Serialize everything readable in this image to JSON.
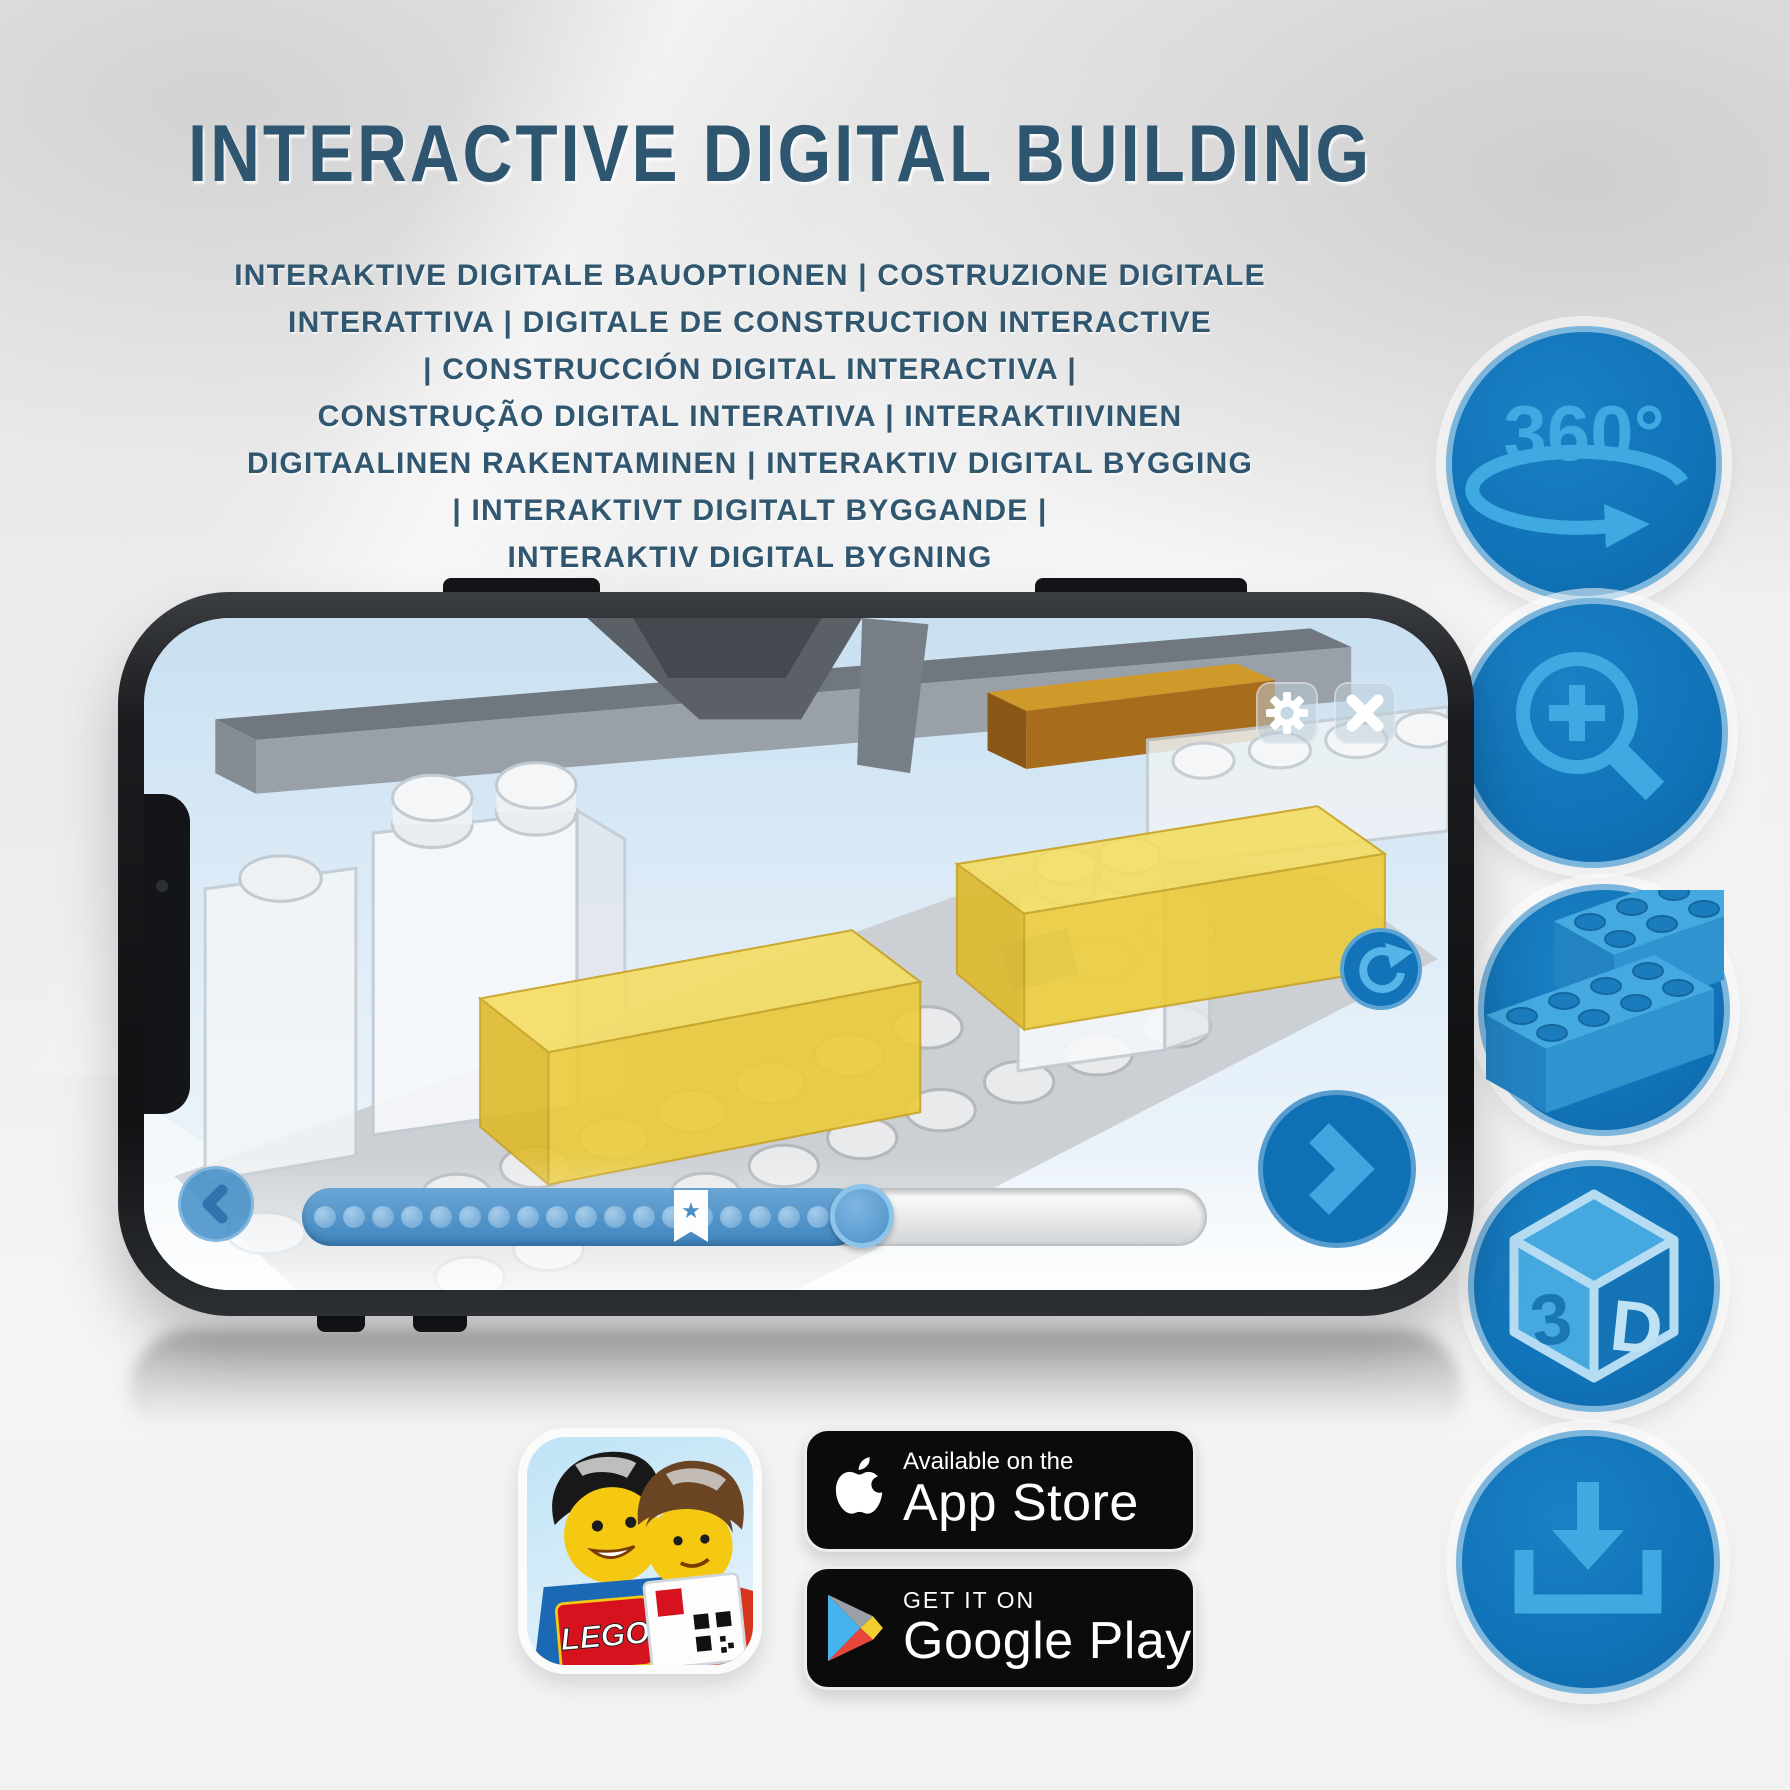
{
  "title": "INTERACTIVE DIGITAL BUILDING",
  "subtitle": {
    "lines": [
      "INTERAKTIVE DIGITALE BAUOPTIONEN | COSTRUZIONE DIGITALE",
      "INTERATTIVA | DIGITALE DE CONSTRUCTION INTERACTIVE",
      "| CONSTRUCCIÓN DIGITAL INTERACTIVA |",
      "CONSTRUÇÃO DIGITAL INTERATIVA | INTERAKTIIVINEN",
      "DIGITAALINEN RAKENTAMINEN | INTERAKTIV DIGITAL BYGGING",
      "| INTERAKTIVT DIGITALT BYGGANDE |",
      "INTERAKTIV DIGITAL BYGNING"
    ]
  },
  "feature_icons": {
    "rotation_360": {
      "label": "360°"
    },
    "cube_3d": {
      "left": "3",
      "right": "D"
    }
  },
  "phone_app": {
    "progress": {
      "percent": 62,
      "dot_count": 18,
      "star_glyph": "★",
      "star_percent": 43
    }
  },
  "app_icon": {
    "logo_text": "LEGO"
  },
  "badges": {
    "app_store": {
      "tagline": "Available on the",
      "store_name": "App Store"
    },
    "google_play": {
      "tagline": "GET IT ON",
      "store_name": "Google Play"
    }
  },
  "colors": {
    "title_text": "#2e5670",
    "icon_circle": "#1173b8",
    "icon_glyph": "#3fa9e1",
    "progress_fill": "#4f90c6",
    "badge_background": "#0b0b0b",
    "brick_yellow": "#f0d23e",
    "screen_sky": "#c9e0f1"
  }
}
